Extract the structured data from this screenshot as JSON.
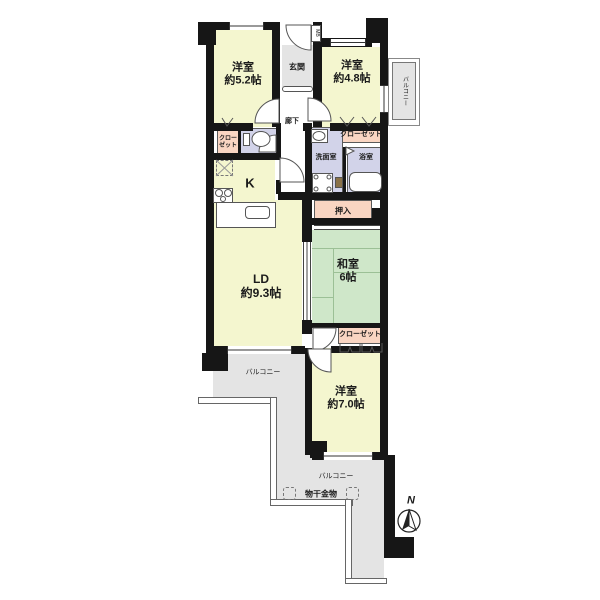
{
  "plan": {
    "bedroom52": {
      "name": "洋室",
      "size": "約5.2帖"
    },
    "bedroom48": {
      "name": "洋室",
      "size": "約4.8帖"
    },
    "bedroom70": {
      "name": "洋室",
      "size": "約7.0帖"
    },
    "washitsu": {
      "name": "和室",
      "size": "6帖"
    },
    "ld": {
      "name": "LD",
      "size": "約9.3帖"
    },
    "kitchen_label": "K",
    "genkan_label": "玄関",
    "hallway_label": "廊下",
    "washroom_label": "洗面室",
    "bathroom_label": "浴室",
    "oshiire_label": "押入",
    "mb_label": "MB",
    "closet_left_label": "クローゼット",
    "closet_upper_label": "クローゼット",
    "closet_lower_label": "クローゼット",
    "balcony_right_label": "バルコニー",
    "balcony_left_label": "バルコニー",
    "balcony_bottom_label": "バルコニー",
    "laundry_label": "物干金物",
    "compass_label": "N"
  },
  "colors": {
    "room_yellow": "#f4f6cf",
    "tatami_green": "#cfe7c9",
    "closet_pink": "#f9d5c2",
    "sanitary_lavender": "#d2d3e9",
    "balcony_gray": "#e4e4e4",
    "wall_black": "#161616"
  }
}
